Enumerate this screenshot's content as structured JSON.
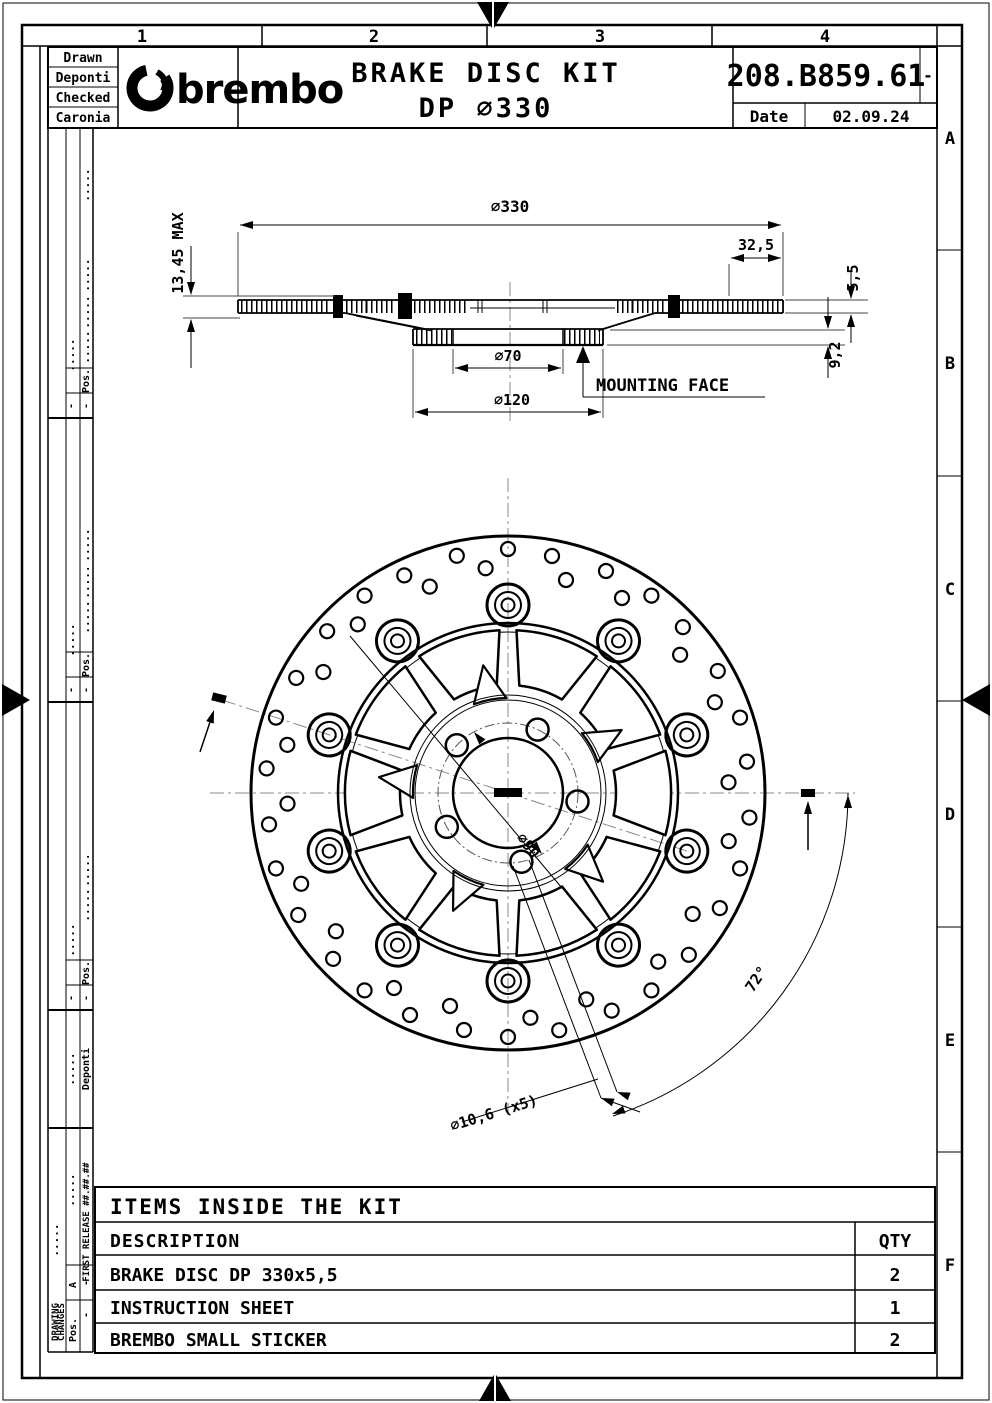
{
  "sheet": {
    "zones_top": [
      "1",
      "2",
      "3",
      "4"
    ],
    "zones_right": [
      "A",
      "B",
      "C",
      "D",
      "E",
      "F"
    ]
  },
  "title_block": {
    "drawn_label": "Drawn",
    "drawn_name": "Deponti",
    "checked_label": "Checked",
    "checked_name": "Caronia",
    "brand": "brembo",
    "title_line1": "BRAKE DISC KIT",
    "title_line2": "DP ∅330",
    "part_number": "208.B859.61",
    "revision": "-",
    "date_label": "Date",
    "date_value": "02.09.24"
  },
  "section_view": {
    "dim_outer_diameter": "∅330",
    "dim_band_width": "32,5",
    "dim_max_thickness": "13,45 MAX",
    "dim_bore": "∅70",
    "dim_flange": "∅120",
    "dim_disc_thickness": "5,5",
    "dim_offset": "9,2",
    "mounting_face_label": "MOUNTING FACE"
  },
  "front_view": {
    "dim_bolt_circle": "∅90",
    "dim_bolt_holes": "∅10,6 (x5)",
    "dim_hole_angle": "72°"
  },
  "revision_panel": {
    "header_line1": "DRAWING",
    "header_line2": "CHANGES",
    "pos_label": "Pos.",
    "revision_letter": "A",
    "first_release": "FIRST RELEASE ##.##.##",
    "author": "Deponti",
    "dots": ".....",
    "dash": "-"
  },
  "items_table": {
    "title": "ITEMS INSIDE THE KIT",
    "description_header": "DESCRIPTION",
    "qty_header": "QTY",
    "rows": [
      {
        "description": "BRAKE DISC DP 330x5,5",
        "qty": "2"
      },
      {
        "description": "INSTRUCTION SHEET",
        "qty": "1"
      },
      {
        "description": "BREMBO SMALL STICKER",
        "qty": "2"
      }
    ]
  },
  "colors": {
    "ink": "#000000",
    "centerline": "#888888",
    "paper": "#ffffff"
  }
}
